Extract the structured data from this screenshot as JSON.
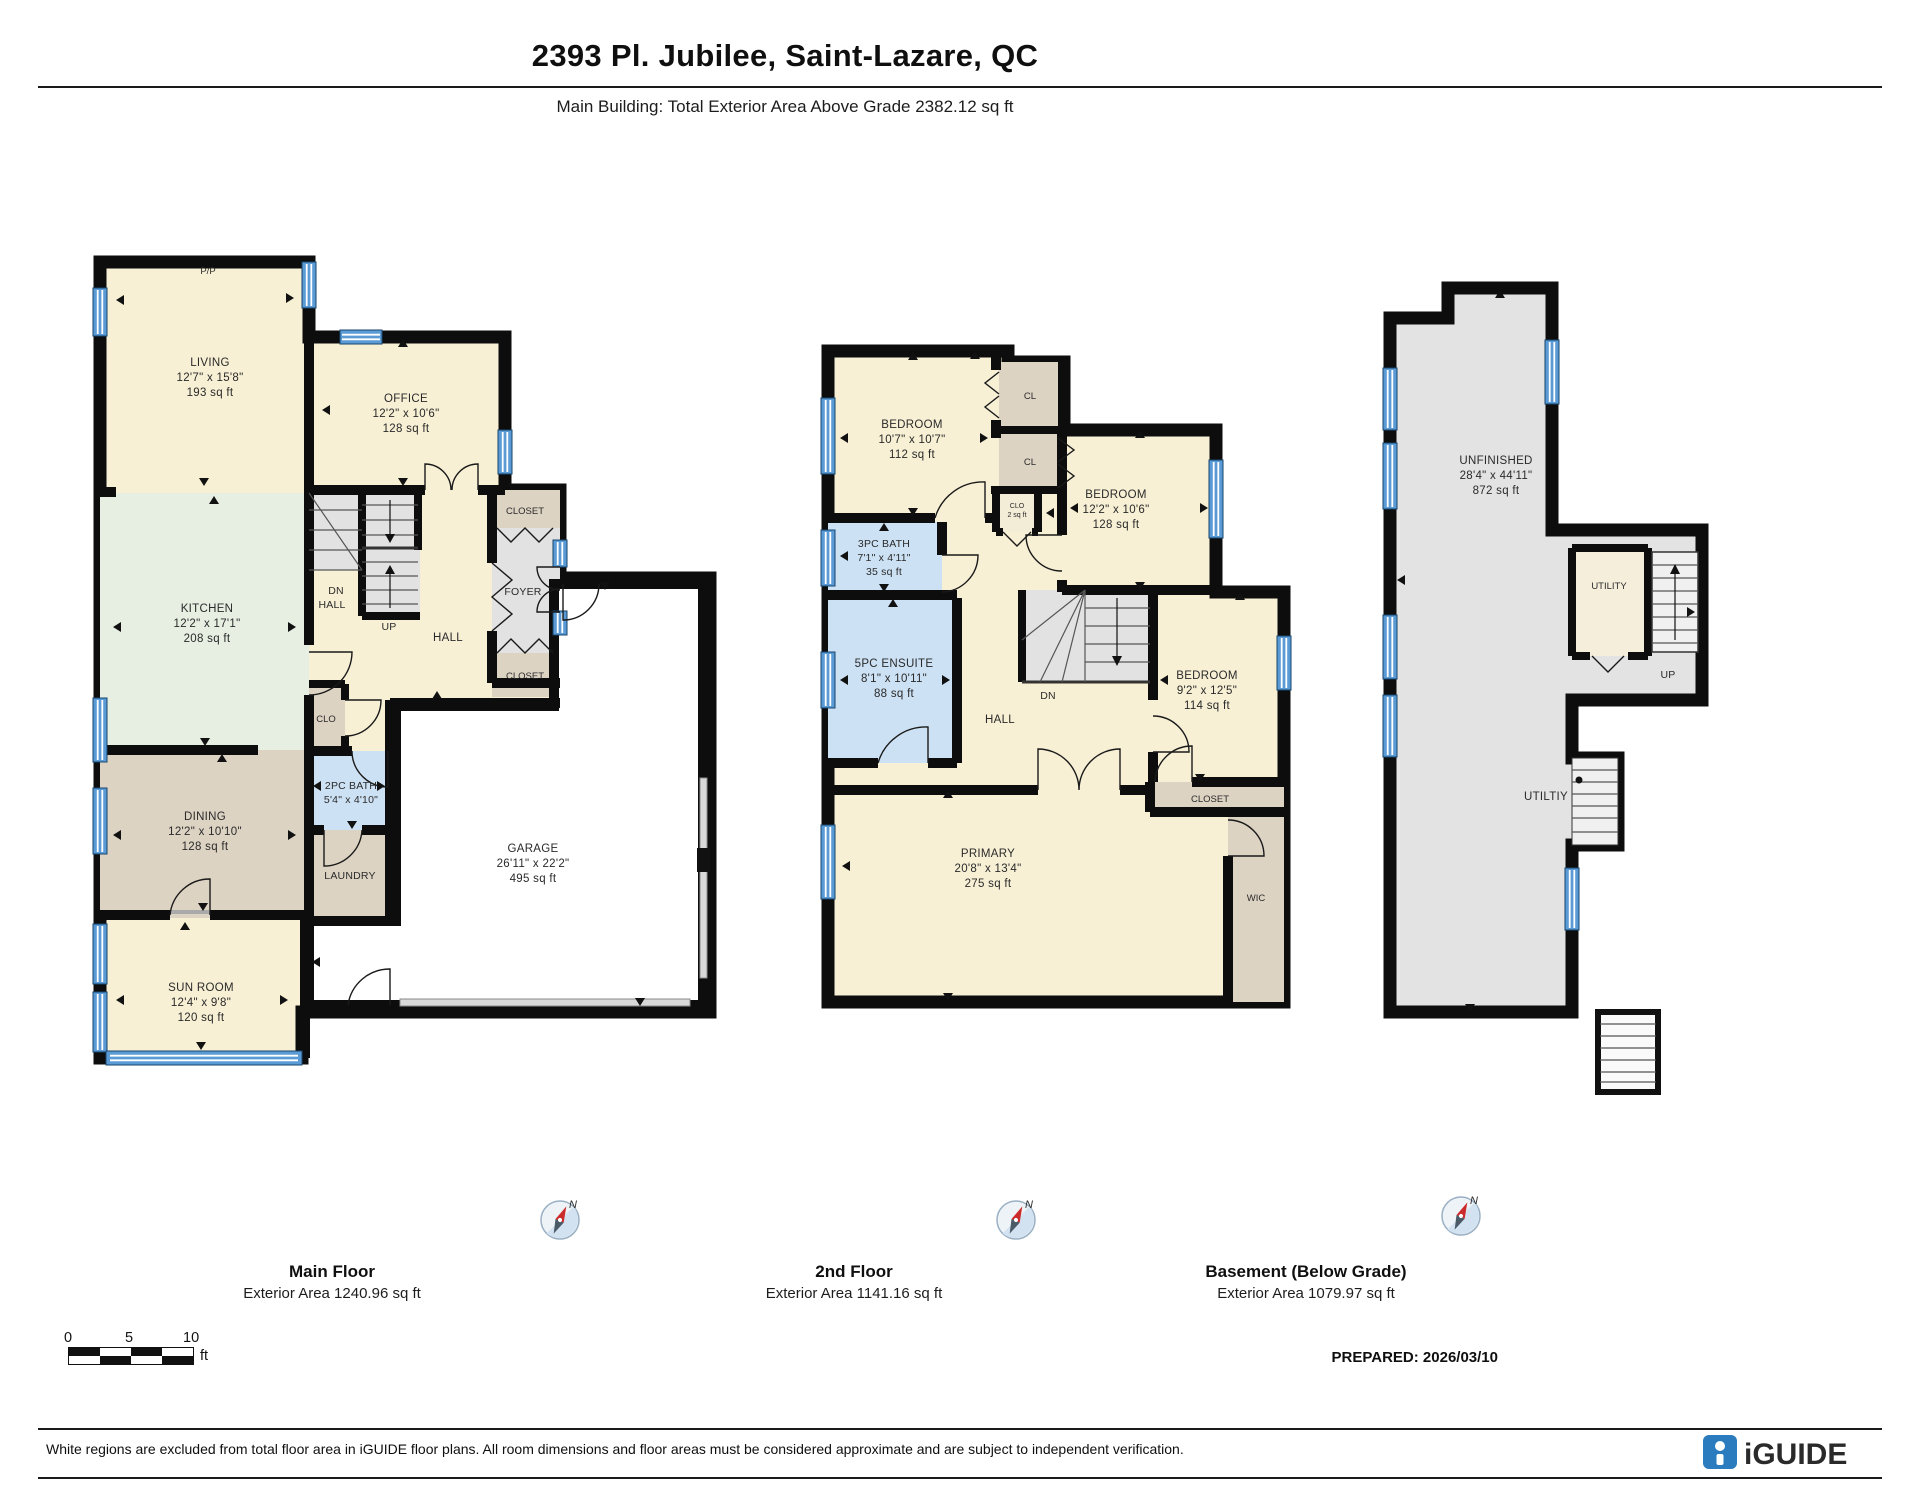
{
  "header": {
    "title": "2393 Pl. Jubilee, Saint-Lazare, QC",
    "subtitle": "Main Building: Total Exterior Area Above Grade 2382.12 sq ft"
  },
  "plans": {
    "main": {
      "floor_title": "Main Floor",
      "floor_area": "Exterior Area 1240.96 sq ft",
      "pp": "P/P",
      "living": {
        "name": "LIVING",
        "dims": "12'7\" x 15'8\"",
        "area": "193 sq ft"
      },
      "office": {
        "name": "OFFICE",
        "dims": "12'2\" x 10'6\"",
        "area": "128 sq ft"
      },
      "kitchen": {
        "name": "KITCHEN",
        "dims": "12'2\" x 17'1\"",
        "area": "208 sq ft"
      },
      "dining": {
        "name": "DINING",
        "dims": "12'2\" x 10'10\"",
        "area": "128 sq ft"
      },
      "sunroom": {
        "name": "SUN ROOM",
        "dims": "12'4\" x 9'8\"",
        "area": "120 sq ft"
      },
      "garage": {
        "name": "GARAGE",
        "dims": "26'11\" x 22'2\"",
        "area": "495 sq ft"
      },
      "bath": {
        "name": "2PC BATH",
        "dims": "5'4\" x 4'10\""
      },
      "laundry": "LAUNDRY",
      "clo": "CLO",
      "closet_top": "CLOSET",
      "closet_bottom": "CLOSET",
      "foyer": "FOYER",
      "hall": "HALL",
      "stair_dn": "DN",
      "stair_hall": "HALL",
      "up": "UP"
    },
    "second": {
      "floor_title": "2nd Floor",
      "floor_area": "Exterior Area 1141.16 sq ft",
      "bedroom1": {
        "name": "BEDROOM",
        "dims": "10'7\" x 10'7\"",
        "area": "112 sq ft"
      },
      "bedroom2": {
        "name": "BEDROOM",
        "dims": "12'2\" x 10'6\"",
        "area": "128 sq ft"
      },
      "bedroom3": {
        "name": "BEDROOM",
        "dims": "9'2\" x 12'5\"",
        "area": "114 sq ft"
      },
      "primary": {
        "name": "PRIMARY",
        "dims": "20'8\" x 13'4\"",
        "area": "275 sq ft"
      },
      "bath3": {
        "name": "3PC BATH",
        "dims": "7'1\" x 4'11\"",
        "area": "35 sq ft"
      },
      "ensuite": {
        "name": "5PC ENSUITE",
        "dims": "8'1\" x 10'11\"",
        "area": "88 sq ft"
      },
      "cl1": "CL",
      "cl2": "CL",
      "clo_small": {
        "name": "CLO",
        "area": "2 sq ft"
      },
      "hall": "HALL",
      "dn": "DN",
      "closet": "CLOSET",
      "wic": "WIC"
    },
    "basement": {
      "floor_title": "Basement (Below Grade)",
      "floor_area": "Exterior Area 1079.97 sq ft",
      "unfinished": {
        "name": "UNFINISHED",
        "dims": "28'4\" x 44'11\"",
        "area": "872 sq ft"
      },
      "utility": "UTILITY",
      "utility2": "UTILTIY",
      "up": "UP"
    }
  },
  "compass": {
    "north": "N"
  },
  "scale_bar": {
    "tick0": "0",
    "tick5": "5",
    "tick10": "10",
    "unit": "ft"
  },
  "prepared": "PREPARED: 2026/03/10",
  "footer": {
    "disclaimer": "White regions are excluded from total floor area in iGUIDE floor plans. All room dimensions and floor areas must be considered approximate and are subject to independent verification.",
    "brand": "iGUIDE"
  },
  "colors": {
    "room_cream": "#f7f0d5",
    "room_mint": "#e7efe2",
    "room_tan": "#ddd3c3",
    "room_blue": "#cde1f4",
    "room_gray": "#e2e2e2",
    "wall": "#0d0d0d",
    "window_blue": "#5b9bd5",
    "brand_blue": "#2a7cbe"
  }
}
